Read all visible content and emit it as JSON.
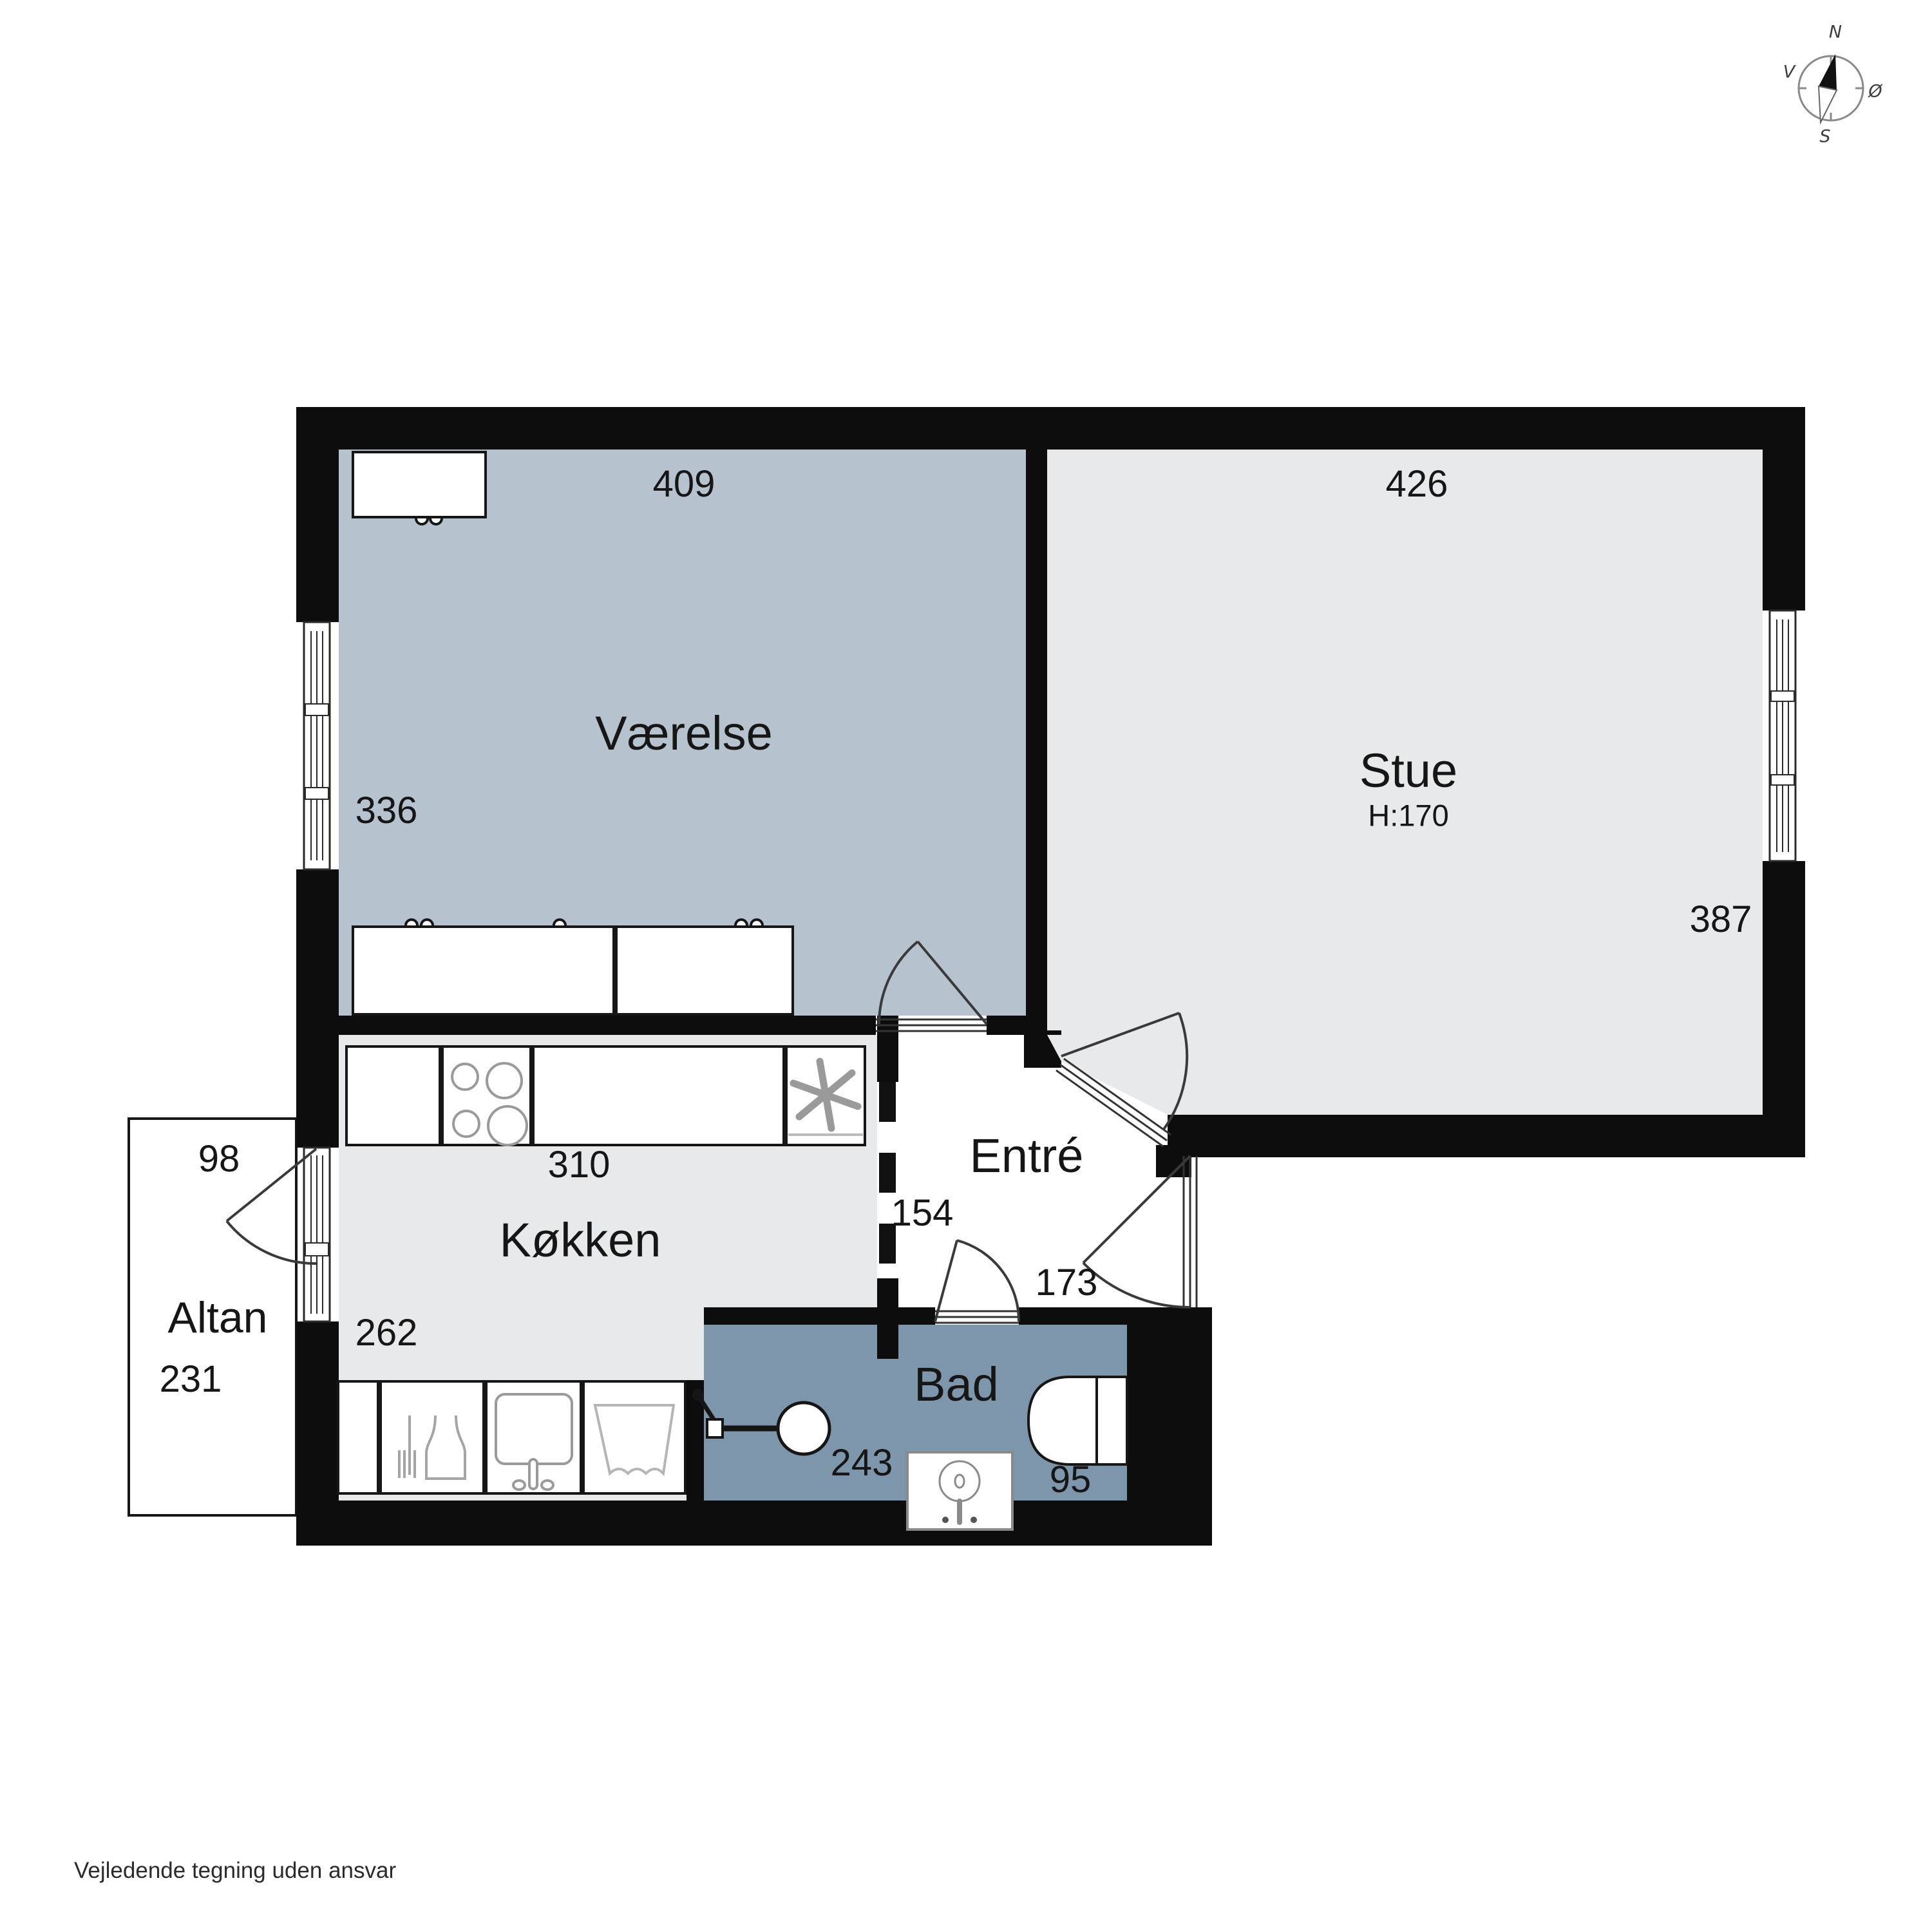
{
  "disclaimer": "Vejledende tegning uden ansvar",
  "compass": {
    "north": "N",
    "east": "Ø",
    "south": "S",
    "west": "V"
  },
  "rooms": {
    "vaerelse": {
      "name": "Værelse",
      "width_cm": "409",
      "depth_cm": "336"
    },
    "stue": {
      "name": "Stue",
      "ceiling_height": "H:170",
      "width_cm": "426",
      "depth_cm": "387"
    },
    "koekken": {
      "name": "Køkken",
      "width_cm": "310",
      "depth_cm": "262"
    },
    "entre": {
      "name": "Entré",
      "width_cm": "154",
      "depth_cm": "173"
    },
    "bad": {
      "name": "Bad",
      "width_cm": "243",
      "depth_cm": "95"
    },
    "altan": {
      "name": "Altan",
      "width_cm": "98",
      "depth_cm": "231"
    }
  },
  "colors": {
    "wall": "#0d0d0d",
    "vaerelse_floor": "#b6c2ce",
    "stue_floor": "#e8e9eb",
    "koekken_floor": "#e8e9eb",
    "entre_floor": "#ffffff",
    "bad_floor": "#7e96ab",
    "altan_floor": "#ffffff",
    "background": "#ffffff"
  }
}
